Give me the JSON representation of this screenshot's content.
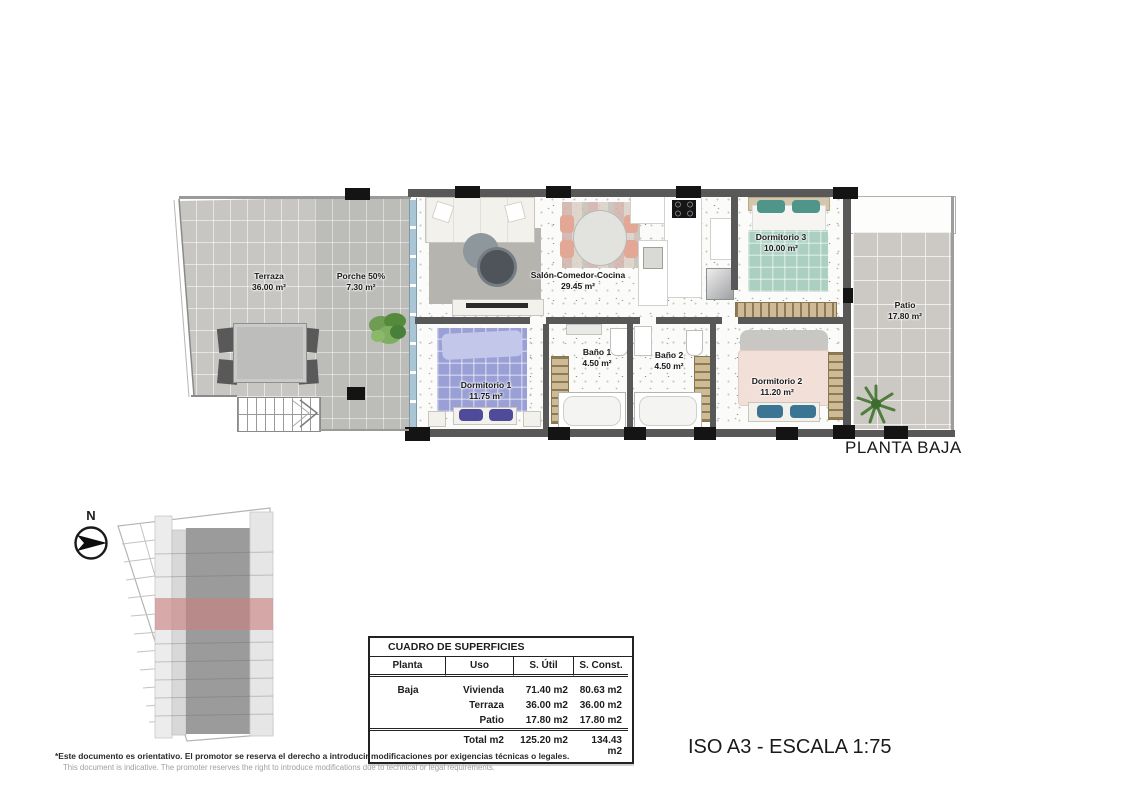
{
  "plan_title": "PLANTA BAJA",
  "compass": {
    "label": "N"
  },
  "rooms": {
    "terraza": {
      "name": "Terraza",
      "area": "36.00 m²"
    },
    "porche": {
      "name": "Porche 50%",
      "area": "7.30 m²"
    },
    "salon": {
      "name": "Salón-Comedor-Cocina",
      "area": "29.45 m²"
    },
    "dormitorio3": {
      "name": "Dormitorio 3",
      "area": "10.00 m²"
    },
    "patio": {
      "name": "Patio",
      "area": "17.80 m²"
    },
    "bano1": {
      "name": "Baño 1",
      "area": "4.50 m²"
    },
    "bano2": {
      "name": "Baño 2",
      "area": "4.50 m²"
    },
    "dormitorio1": {
      "name": "Dormitorio 1",
      "area": "11.75 m²"
    },
    "dormitorio2": {
      "name": "Dormitorio 2",
      "area": "11.20 m²"
    }
  },
  "surface_table": {
    "title": "CUADRO DE SUPERFICIES",
    "columns": [
      "Planta",
      "Uso",
      "S. Útil",
      "S. Const."
    ],
    "rows": [
      {
        "planta": "Baja",
        "uso": "Vivienda",
        "util": "71.40 m2",
        "const": "80.63 m2"
      },
      {
        "planta": "",
        "uso": "Terraza",
        "util": "36.00 m2",
        "const": "36.00 m2"
      },
      {
        "planta": "",
        "uso": "Patio",
        "util": "17.80 m2",
        "const": "17.80 m2"
      }
    ],
    "total": {
      "label": "Total m2",
      "util": "125.20 m2",
      "const": "134.43 m2"
    }
  },
  "footer": {
    "disclaimer_es": "*Este documento es orientativo. El promotor se reserva el derecho a introducir modificaciones por exigencias técnicas o legales.",
    "disclaimer_en": "This document is indicative. The promoter reserves the right to introduce modifications due to technical or legal requirements.",
    "scale_label": "ISO A3 - ESCALA 1:75"
  },
  "colors": {
    "site_highlight_red": "#c97f7f",
    "bed_dormitorio1_purple": "#9aa0d6",
    "bed_dormitorio2_pink": "#f2dfd7",
    "bed_dormitorio3_teal": "#abd0c2",
    "tile_gray": "#c6c5c2",
    "wall_dark": "#585858"
  }
}
